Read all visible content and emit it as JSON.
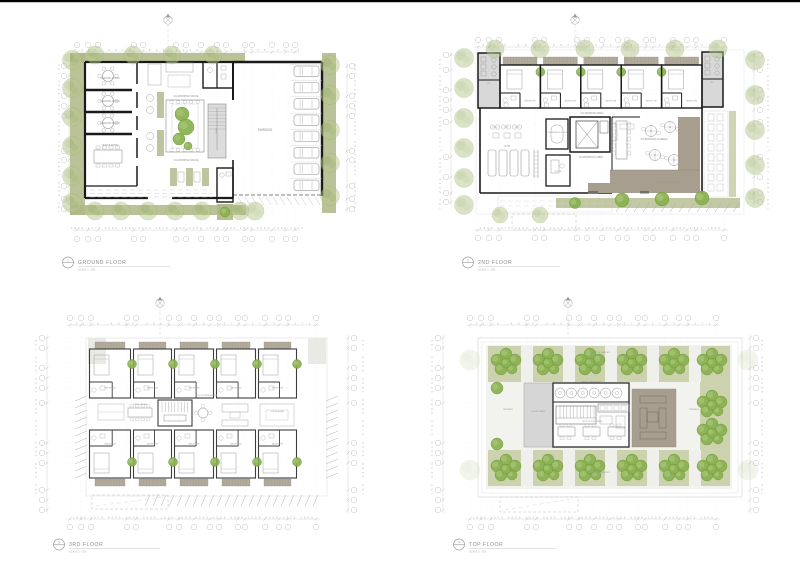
{
  "sheet": {
    "background": "#ffffff",
    "top_border": "#000000"
  },
  "colors": {
    "wall": "#1a1a1a",
    "wall_medium": "#3d3d3d",
    "planting_band": "#aeb786",
    "planting_band_pale": "#c9cfaa",
    "tree_pale": "#b9c78e",
    "tree_bright": "#88b14f",
    "deck": "#a89e90",
    "grey_block": "#d8d8d8",
    "balcony_strip": "#b2aa9b",
    "dim_text": "#b0b0b0",
    "label_text": "#8a8a8a"
  },
  "plans": [
    {
      "number": "1",
      "title": "GROUND FLOOR",
      "scale_note": "SCALE 1 : 100",
      "labels": {
        "meeting_room": "MEETING ROOM",
        "office_room": "OFFICE ROOM",
        "coworking_space": "CO-WORKING SPACE",
        "parking": "PARKING",
        "stair": "STAIR"
      },
      "dims": {
        "top": "3275 4800 4800 2650 4075 2725 3275",
        "bottom": "1900 1375 4000 1525 4000 1525 2000 2000 1525 4000 1525 4000 1375 1900",
        "left": "750 2300 1400 1700 4650 1400 2300 750",
        "right": "750 2300 1400 1700 4650 1400 2300 750"
      }
    },
    {
      "number": "2",
      "title": "2ND FLOOR",
      "scale_note": "SCALE 1 : 100",
      "labels": {
        "bedroom": "BEDROOM",
        "coworking_area": "CO-WORKING AREA",
        "gym": "GYM",
        "conference_room": "CONFERENCE ROOM",
        "coworking_lobby": "CO-WORKING LOBBY",
        "office": "OFFICE",
        "coworking_garden": "CO-WORKING GARDEN",
        "coworking_outdoor": "CO-WORKING OUTDOOR",
        "wc": "WC"
      },
      "dims": {
        "top": "3275 4800 4800 2650 4075 2725 3275",
        "bottom": "1900 1375 4000 1525 4000 1525 2000 2000 1525 4000 1525 4000 1375 1900",
        "left": "750 2300 1400 1700 4650 1400 2300 750",
        "right": "750 2300 1400 1700 4650 1400 2300 750"
      }
    },
    {
      "number": "3",
      "title": "3RD FLOOR",
      "scale_note": "SCALE 1 : 100",
      "labels": {
        "bedroom": "BEDROOM",
        "dining_area": "DINING AREA",
        "coworking_area": "CO-WORKING AREA",
        "living_area": "LIVING AREA"
      },
      "dims": {
        "top": "3275 4800 4800 2650 4075 2725 3275",
        "bottom": "1900 1375 4000 1525 4000 1525 2000 2000 1525 4000 1525 4000 1375 1900",
        "left": "750 2300 1400 1700 4650 1400 2300 750",
        "right": "750 2300 1400 1700 4650 1400 2300 750"
      }
    },
    {
      "number": "4",
      "title": "TOP FLOOR",
      "scale_note": "SCALE 1 : 100",
      "labels": {
        "water_treatment": "WATER TREATMENT",
        "solar_panel": "SOLAR PANEL",
        "outdoor_kitchen": "OUTDOOR KITCHEN",
        "terrace": "TERRACE",
        "rooftop_garden": "ROOFTOP GARDEN"
      },
      "dims": {
        "top": "3275 4800 4800 2650 4075 2725 3275",
        "bottom": "1900 1375 4000 1525 4000 1525 2000 2000 1525 4000 1525 4000 1375 1900",
        "left": "750 2300 1400 1700 4650 1400 2300 750",
        "right": "750 2300 1400 1700 4650 1400 2300 750"
      }
    }
  ]
}
